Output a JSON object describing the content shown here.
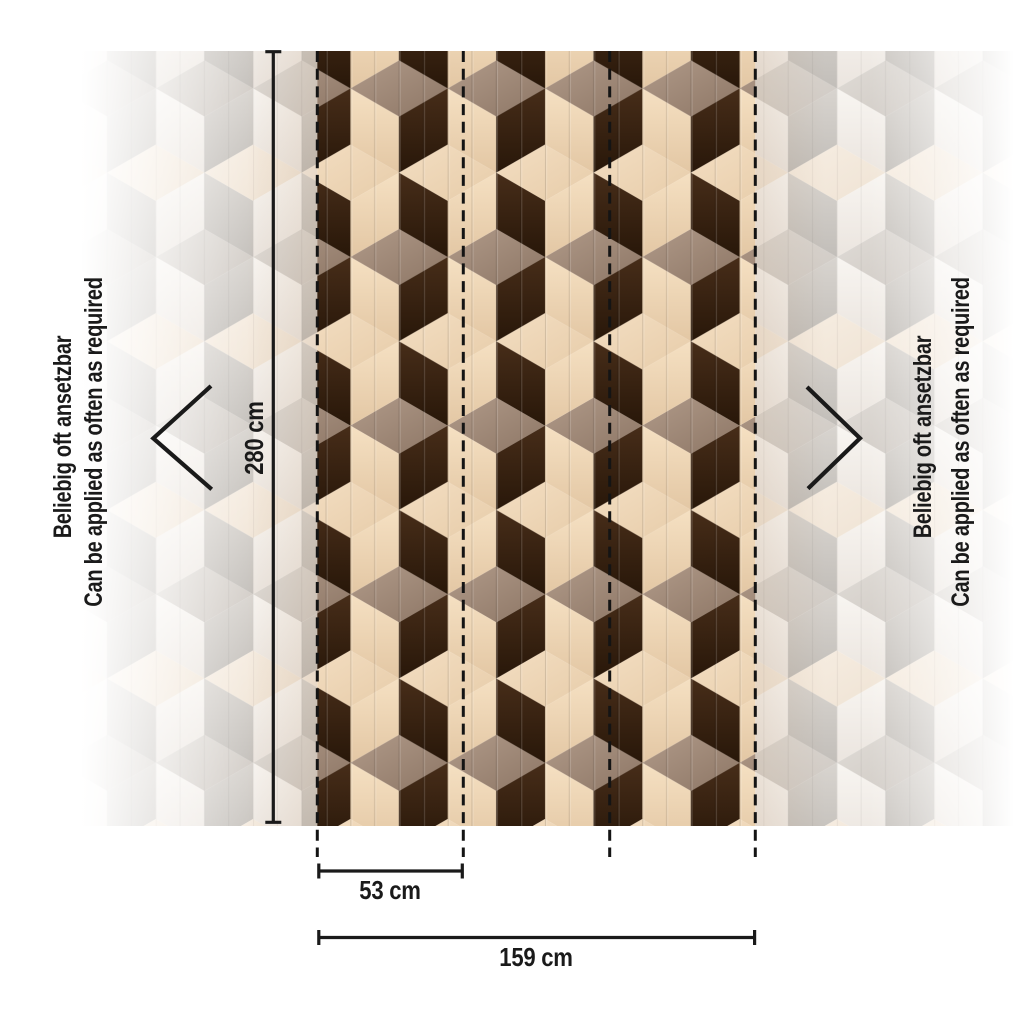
{
  "illustration": {
    "height_dimension": {
      "label": "280 cm"
    },
    "strip_width_dimension": {
      "label": "53 cm"
    },
    "total_width_dimension": {
      "label": "159 cm"
    },
    "repeat_note": {
      "de": "Beliebig oft ansetzbar",
      "en": "Can be applied as often as required"
    }
  },
  "colors": {
    "background": "#ffffff",
    "annotation": "#1a1a1a",
    "seam_dash": "#141414",
    "edge_warm": "#a97f54",
    "vivid": {
      "top_taupe_1": "#b09a89",
      "top_taupe_2": "#8d7665",
      "top_cream_1": "#f3dec2",
      "top_cream_2": "#e7ccа9",
      "top_cream_2b": "#e7cca9",
      "side_cream_1": "#f5e0c2",
      "side_cream_2": "#e3c7a4",
      "side_dark_1": "#472d19",
      "side_dark_2": "#281709"
    },
    "faded": {
      "top_gray_1": "#e0dcd7",
      "top_gray_2": "#cec8c2",
      "top_cream_1": "#f7eee3",
      "top_cream_2": "#efe3d4",
      "side_white_1": "#f8f5f1",
      "side_white_2": "#ebe5df",
      "side_gray_1": "#d8d4cf",
      "side_gray_2": "#c2beb9"
    }
  }
}
